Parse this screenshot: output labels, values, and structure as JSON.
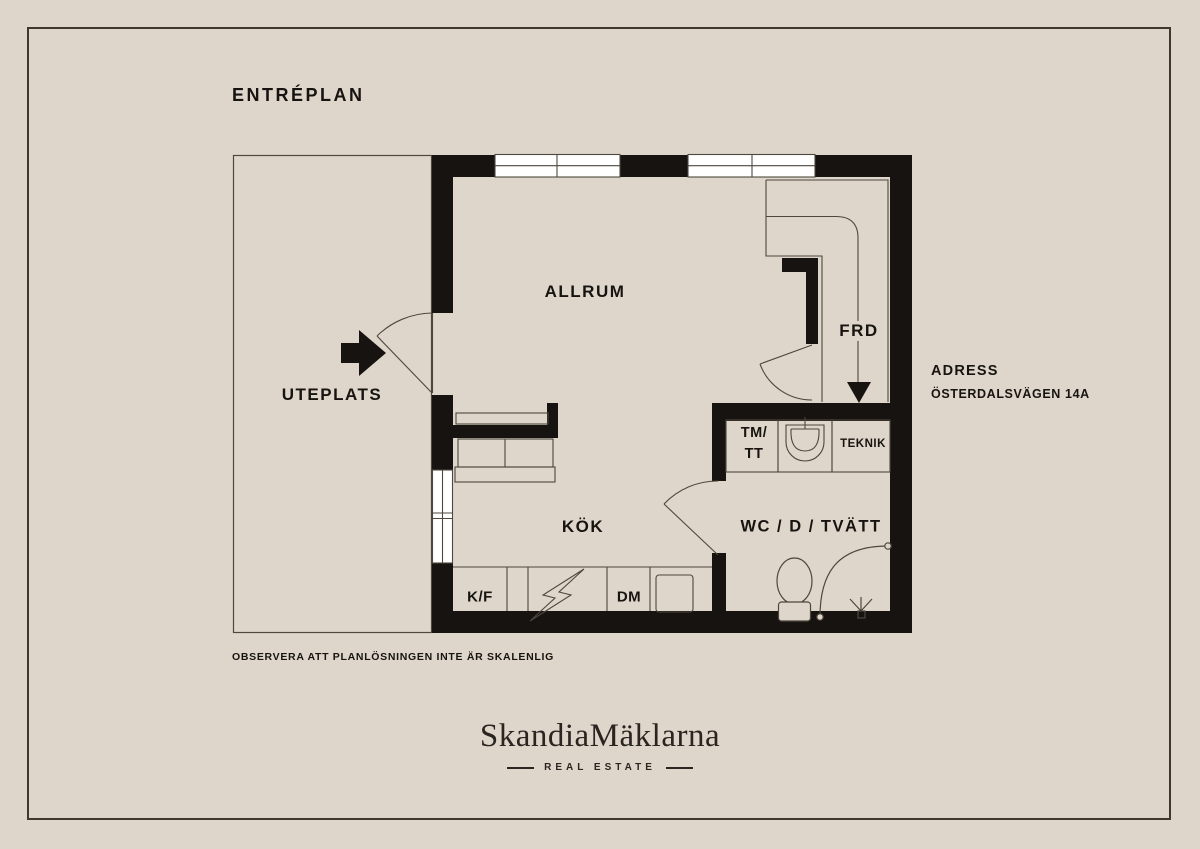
{
  "title": "ENTRÉPLAN",
  "floorplan": {
    "rooms": {
      "allrum": "ALLRUM",
      "uteplats": "UTEPLATS",
      "frd": "FRD",
      "kok": "KÖK",
      "wc": "WC / D / TVÄTT",
      "teknik": "TEKNIK",
      "tm_tt_line1": "TM/",
      "tm_tt_line2": "TT",
      "kf": "K/F",
      "dm": "DM"
    },
    "icons": {
      "entrance": "entrance-arrow-icon",
      "entry_path": "entry-path-arrow-icon",
      "doors": "door-swing-icon",
      "windows": "window-icon",
      "toilet": "toilet-icon",
      "shower": "shower-icon",
      "washbasin": "washbasin-icon",
      "stove": "lightning-icon",
      "kitchen_sink": "kitchen-sink-icon",
      "sofa": "sofa-icon"
    }
  },
  "address": {
    "heading": "ADRESS",
    "street": "ÖSTERDALSVÄGEN 14A"
  },
  "disclaimer": "OBSERVERA ATT PLANLÖSNINGEN INTE ÄR SKALENLIG",
  "brand": {
    "name": "SkandiaMäklarna",
    "tagline": "REAL ESTATE"
  },
  "colors": {
    "background": "#DED6CA",
    "wall": "#171310",
    "line": "#4E473D",
    "window": "#FFFFFF",
    "frame": "#3E382E",
    "text": "#171310",
    "brand": "#2B2521"
  }
}
